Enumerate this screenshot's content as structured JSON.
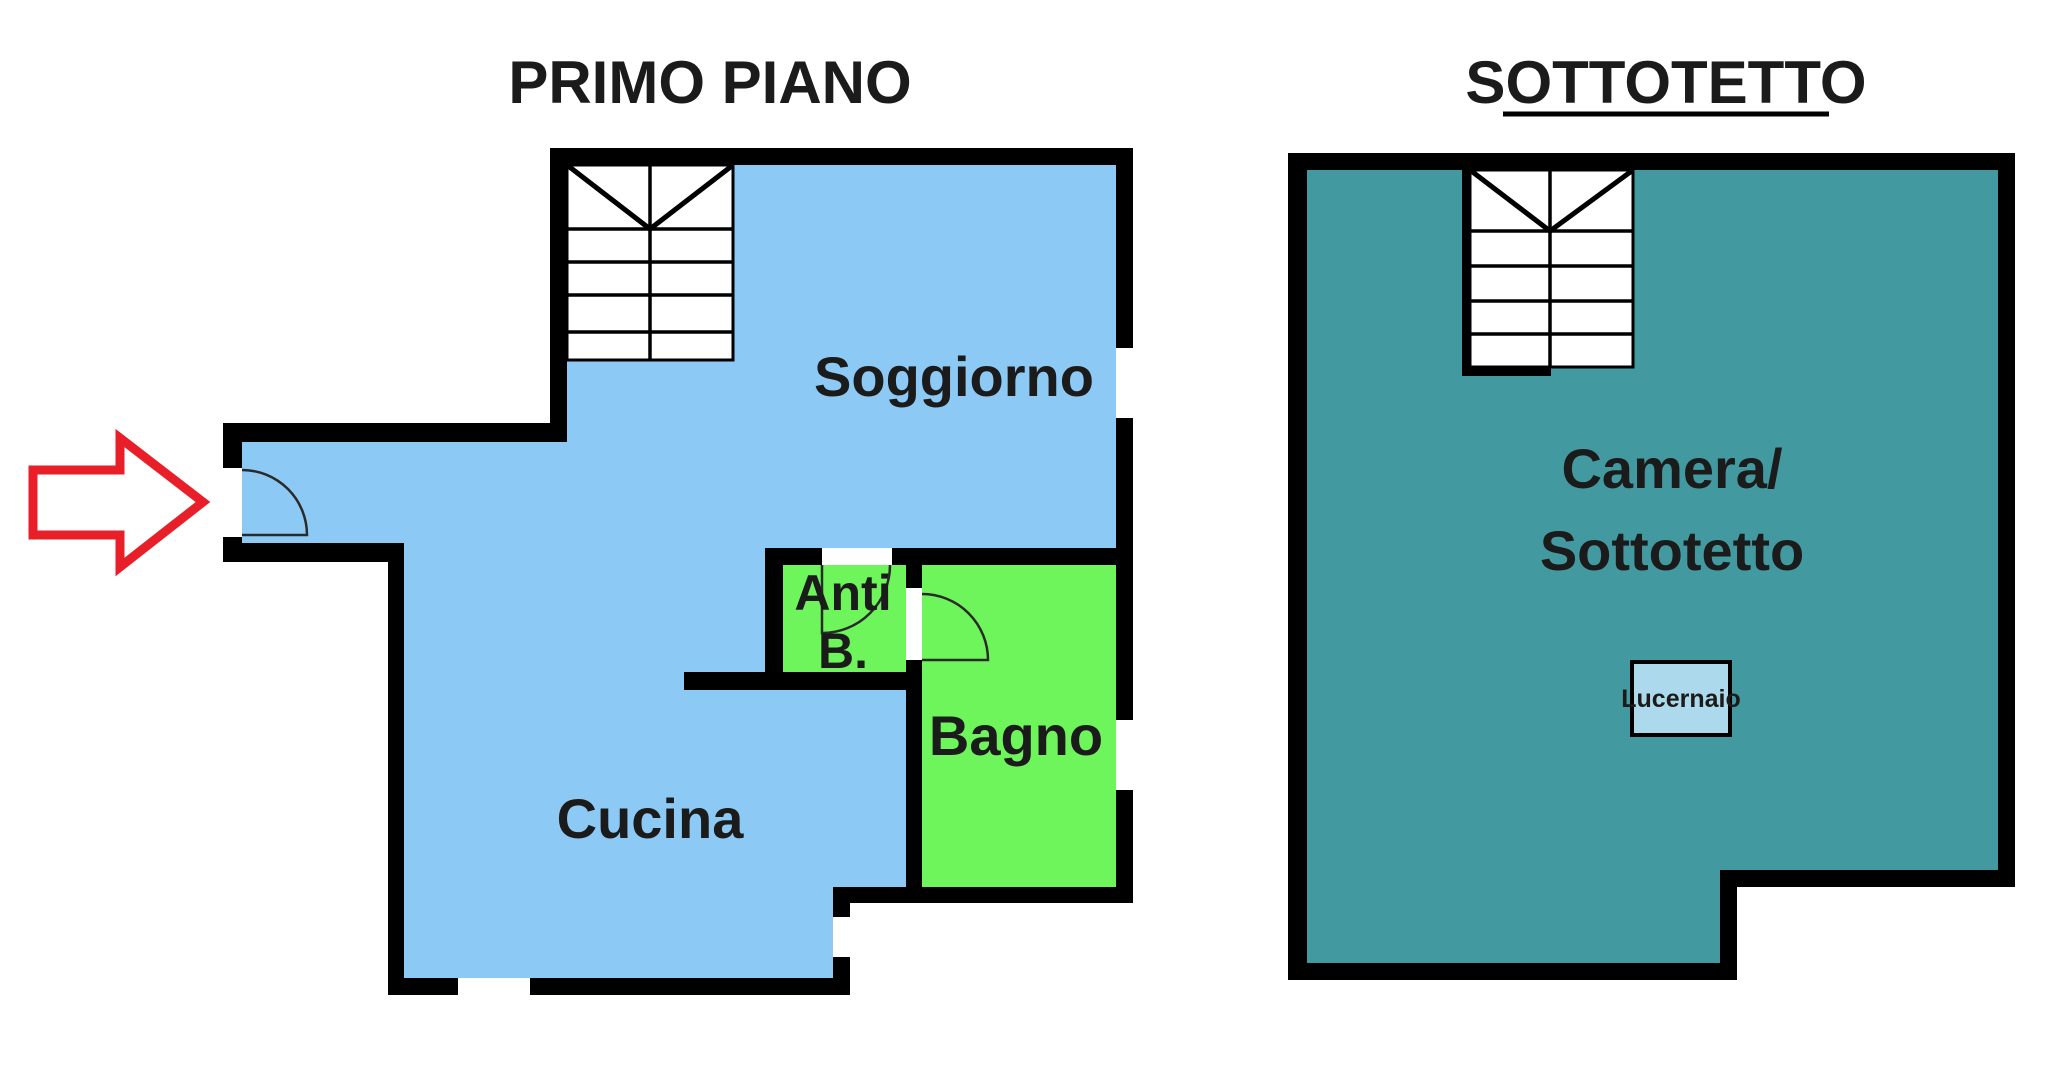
{
  "titles": {
    "primo_piano": "PRIMO PIANO",
    "sottotetto": "SOTTOTETTO"
  },
  "primo_piano": {
    "soggiorno": "Soggiorno",
    "cucina": "Cucina",
    "bagno": "Bagno",
    "anti_b_line1": "Anti",
    "anti_b_line2": "B."
  },
  "sottotetto": {
    "camera_line1": "Camera/",
    "camera_line2": "Sottotetto",
    "lucernaio": "Lucernaio"
  },
  "colors": {
    "room_blue": "#8CCAF5",
    "room_green": "#6EF55C",
    "room_teal": "#429AA0",
    "skylight_blue": "#ADD9EC",
    "arrow_red": "#E81E28",
    "wall_black": "#000000",
    "text_dark": "#1b1b1b"
  }
}
